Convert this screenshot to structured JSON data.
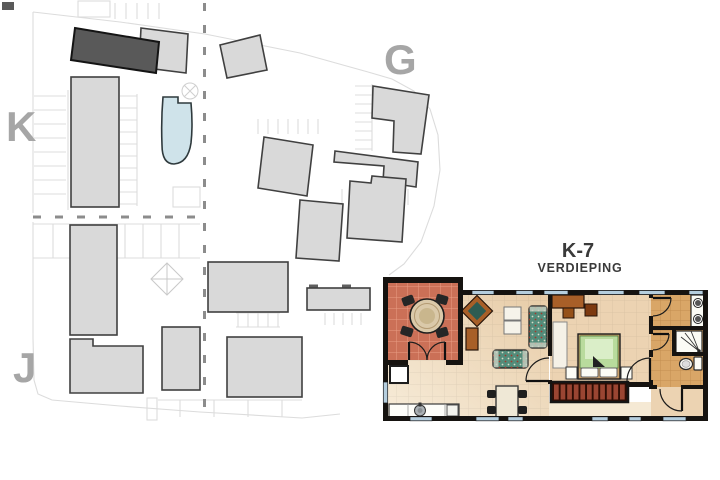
{
  "title": {
    "unit": "K-7",
    "subtitle": "VERDIEPING"
  },
  "site_plan": {
    "labels": {
      "k": "K",
      "g": "G",
      "j": "J"
    }
  },
  "colors": {
    "background": "#ffffff",
    "building_fill": "#d9d9d9",
    "building_stroke": "#404040",
    "highlight_fill": "#595959",
    "label_gray": "#a6a6a6",
    "parcel_line": "#dcdcdc",
    "dash_gray": "#8c8c8c",
    "pool_fill": "#cfe3ea",
    "pool_stroke": "#2f3a3d",
    "wall_black": "#161310",
    "title_color": "#3a3a3a",
    "terrace_floor": "#cb7057",
    "living_floor": "#f5e9d4",
    "living_floor_deep": "#e7cba6",
    "bedroom_floor": "#ecd3b2",
    "bath_floor": "#d9a667",
    "window_blue": "#b5cede",
    "stair_red": "#9a4532",
    "stair_dark": "#2e0d04",
    "bed_green": "#b9db9d",
    "bed_green_light": "#daeec8",
    "sofa_teal": "#538c7a",
    "wood_brown": "#a85f28",
    "table_cream": "#efe8d6",
    "fixture_white": "#fbfbf5"
  }
}
